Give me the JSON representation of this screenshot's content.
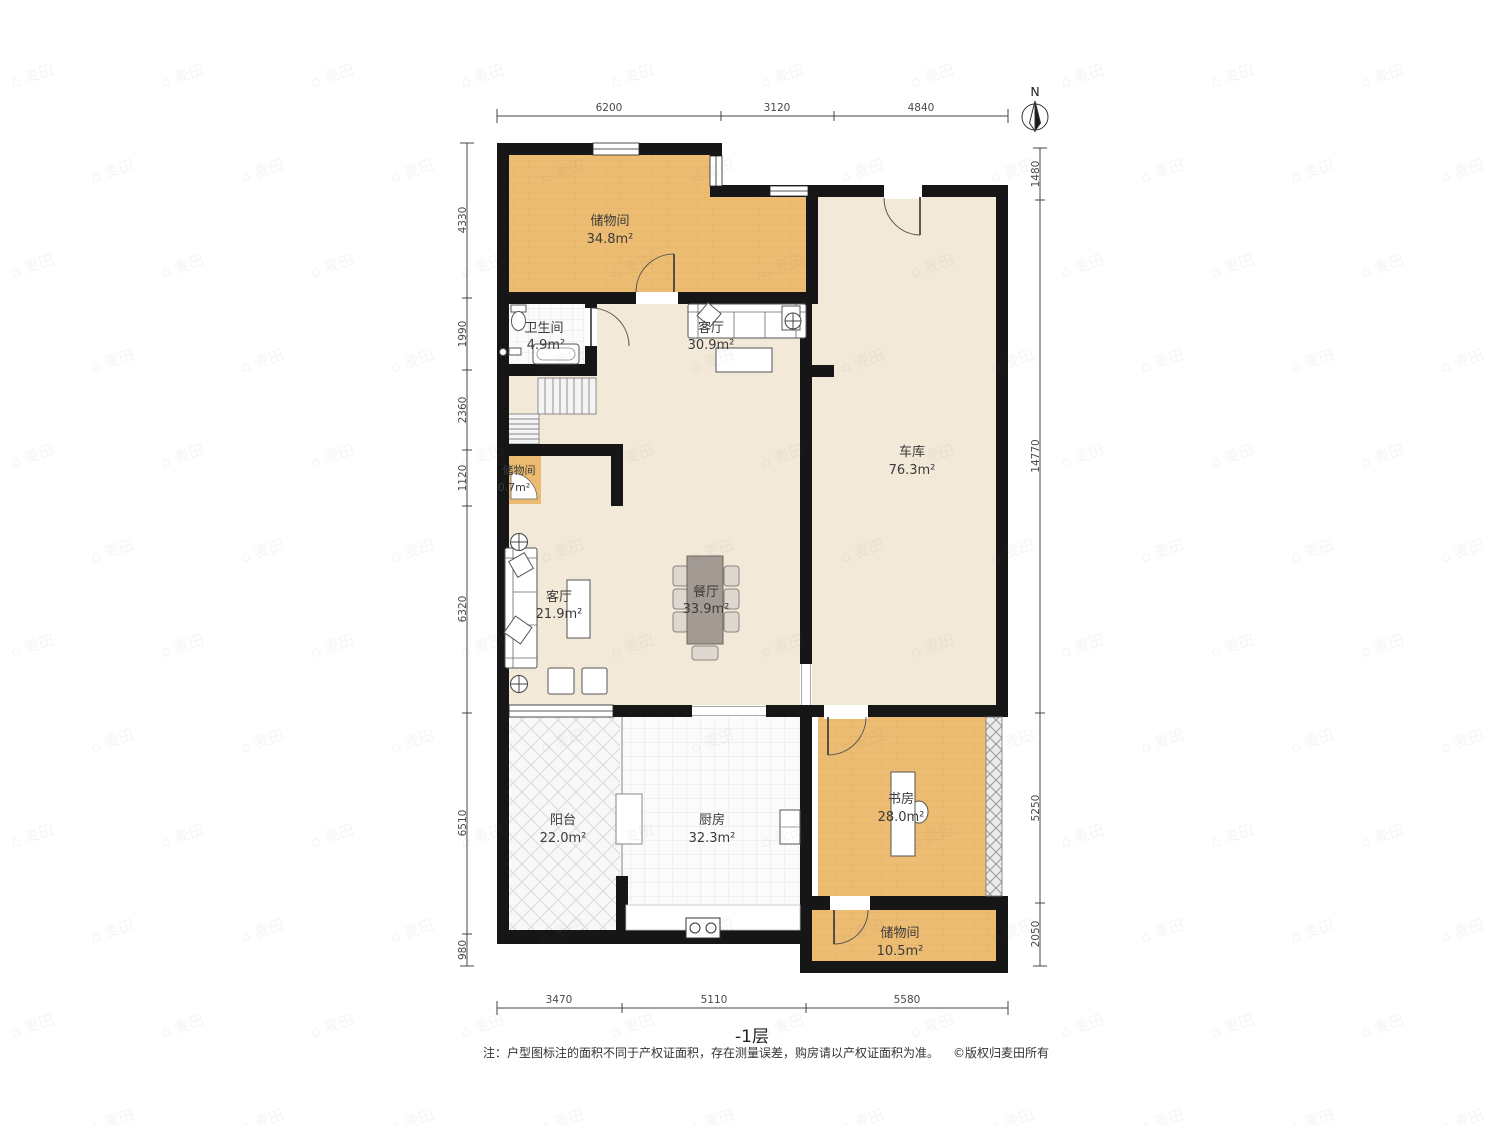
{
  "compass": {
    "label": "N"
  },
  "rooms": {
    "storage_top": {
      "name": "储物间",
      "area": "34.8m²"
    },
    "bathroom": {
      "name": "卫生间",
      "area": "4.9m²"
    },
    "living_upper": {
      "name": "客厅",
      "area": "30.9m²"
    },
    "garage": {
      "name": "车库",
      "area": "76.3m²"
    },
    "storage_small": {
      "name": "储物间",
      "area": "0.7m²"
    },
    "living": {
      "name": "客厅",
      "area": "21.9m²"
    },
    "dining": {
      "name": "餐厅",
      "area": "33.9m²"
    },
    "balcony": {
      "name": "阳台",
      "area": "22.0m²"
    },
    "kitchen": {
      "name": "厨房",
      "area": "32.3m²"
    },
    "study": {
      "name": "书房",
      "area": "28.0m²"
    },
    "storage_bottom": {
      "name": "储物间",
      "area": "10.5m²"
    }
  },
  "dimensions": {
    "top": [
      "6200",
      "3120",
      "4840"
    ],
    "left": [
      "4330",
      "1990",
      "2360",
      "1120",
      "6320",
      "6510",
      "980"
    ],
    "right": [
      "1480",
      "14770",
      "5250",
      "2050"
    ],
    "bottom": [
      "3470",
      "5110",
      "5580"
    ]
  },
  "footer": {
    "floor_label": "-1层",
    "note": "注：户型图标注的面积不同于产权证面积，存在测量误差，购房请以产权证面积为准。",
    "copyright": "©版权归麦田所有"
  },
  "watermark": {
    "text": "麦田",
    "icon": "house-icon"
  },
  "colors": {
    "wall": "#161616",
    "wood_floor": "#ecbc72",
    "cement_floor": "#f2e9d8",
    "table_gray": "#a29a93"
  }
}
